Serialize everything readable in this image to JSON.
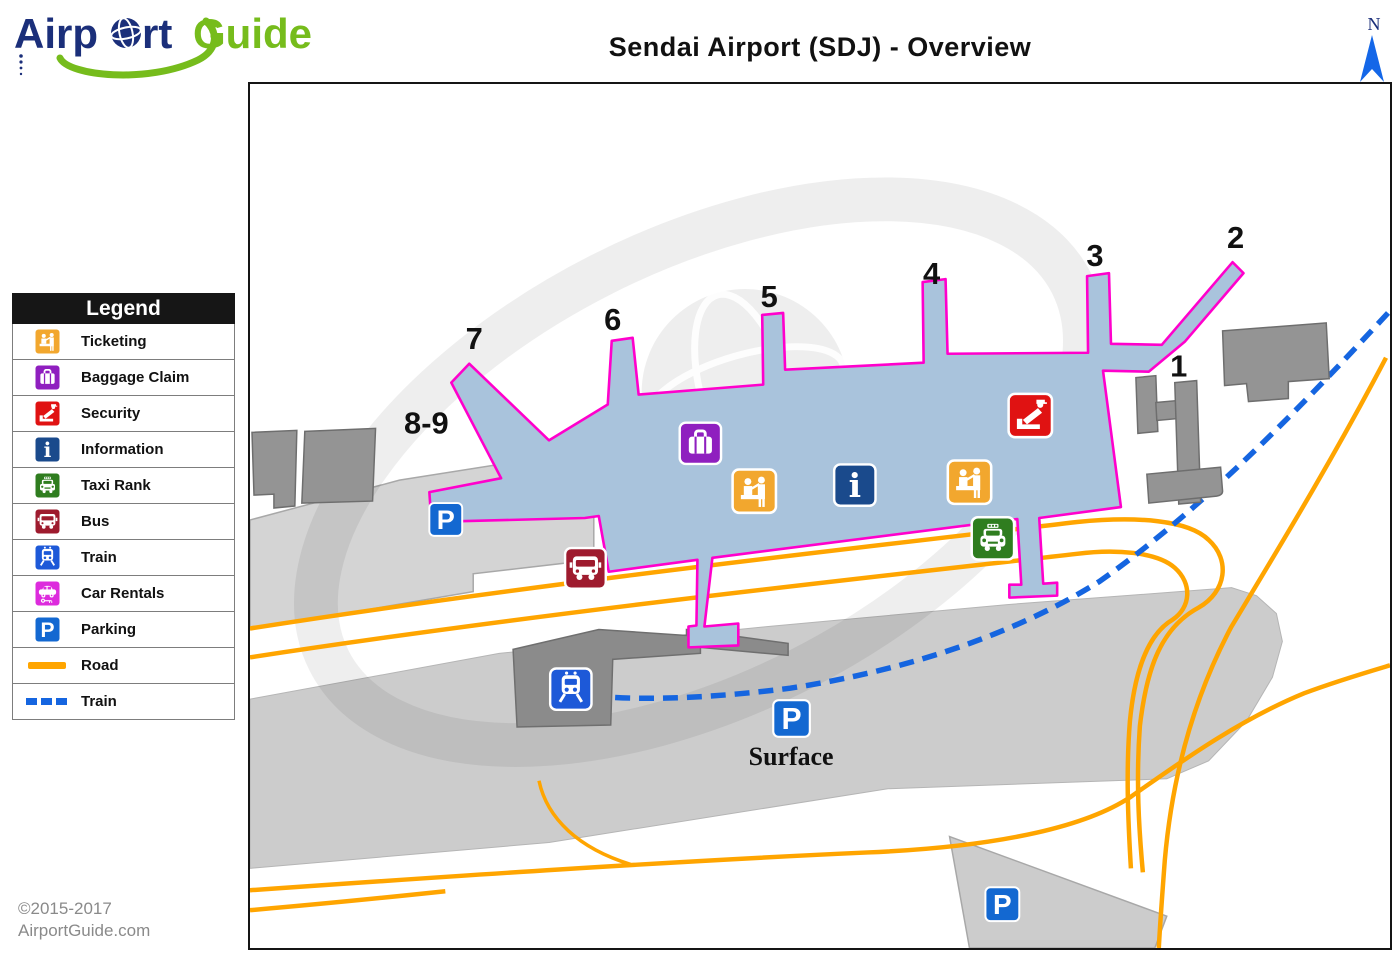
{
  "logo": {
    "part1": "Airp",
    "part2": "rt",
    "part3": "Guide",
    "navy": "#1B2F7A",
    "green": "#76BC1C"
  },
  "title": "Sendai Airport (SDJ) - Overview",
  "compass": {
    "label": "N",
    "color": "#1467E8",
    "label_color": "#1B2F7A"
  },
  "legend": {
    "header": "Legend",
    "items": [
      {
        "name": "ticketing",
        "label": "Ticketing",
        "color": "#F2A72E",
        "swatch": "icon"
      },
      {
        "name": "baggage-claim",
        "label": "Baggage Claim",
        "color": "#8F1FBF",
        "swatch": "icon"
      },
      {
        "name": "security",
        "label": "Security",
        "color": "#E01212",
        "swatch": "icon"
      },
      {
        "name": "information",
        "label": "Information",
        "color": "#1A4A8C",
        "swatch": "icon"
      },
      {
        "name": "taxi-rank",
        "label": "Taxi Rank",
        "color": "#2F7D1F",
        "swatch": "icon"
      },
      {
        "name": "bus",
        "label": "Bus",
        "color": "#9E1B2E",
        "swatch": "icon"
      },
      {
        "name": "train",
        "label": "Train",
        "color": "#1D59D8",
        "swatch": "icon"
      },
      {
        "name": "car-rentals",
        "label": "Car Rentals",
        "color": "#DD2BDD",
        "swatch": "icon"
      },
      {
        "name": "parking",
        "label": "Parking",
        "color": "#1368D1",
        "swatch": "icon"
      },
      {
        "name": "road",
        "label": "Road",
        "color": "#FFA500",
        "swatch": "line"
      },
      {
        "name": "train-line",
        "label": "Train",
        "color": "#1565E0",
        "swatch": "dashed-line"
      }
    ]
  },
  "map": {
    "gates": [
      "7",
      "6",
      "5",
      "4",
      "3",
      "2",
      "1",
      "8-9"
    ],
    "surface_parking_label": "Surface",
    "parking_letter": "P",
    "info_letter": "i",
    "terminal_fill": "#A9C3DC",
    "terminal_outline": "#FF00CC",
    "road_color": "#FFA500",
    "train_line_color": "#1565E0"
  },
  "footer": {
    "copyright": "©2015-2017",
    "site": "AirportGuide.com"
  }
}
